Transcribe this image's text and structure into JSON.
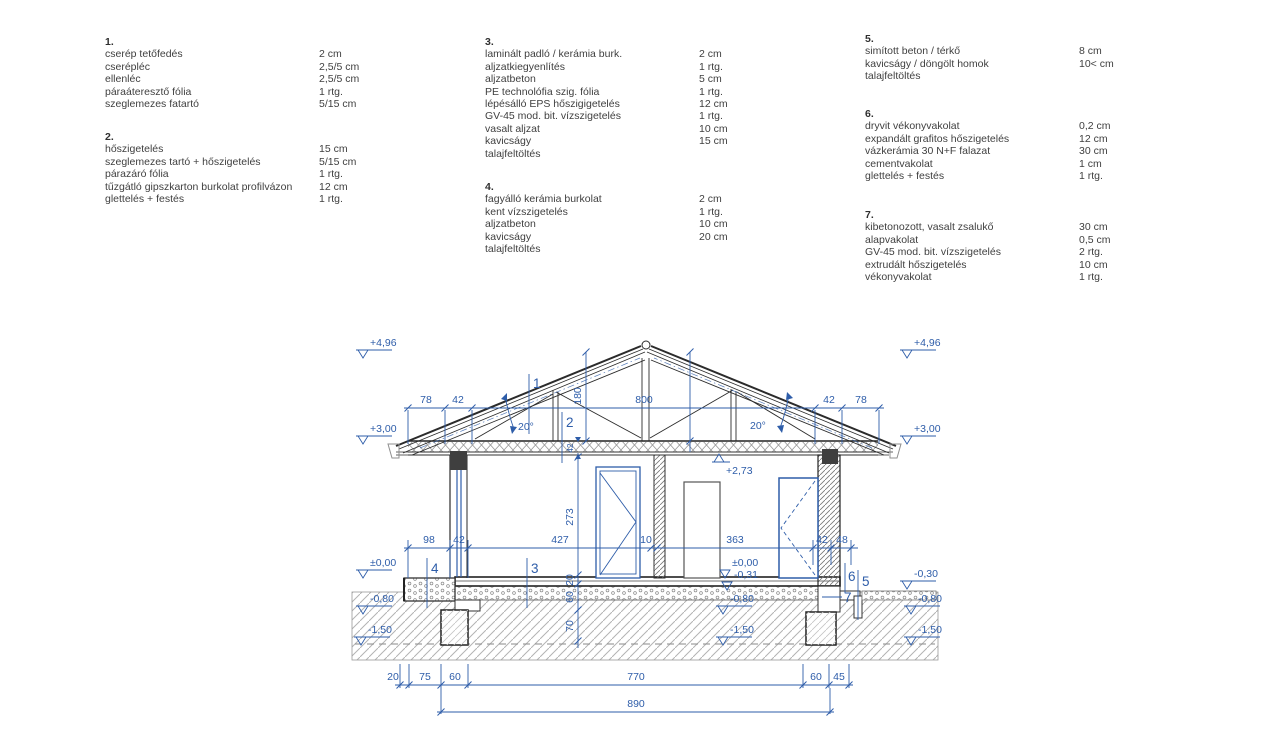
{
  "specs": {
    "s1": {
      "num": "1.",
      "rows": [
        [
          "cserép tetőfedés",
          "2 cm"
        ],
        [
          "cserépléc",
          "2,5/5 cm"
        ],
        [
          "ellenléc",
          "2,5/5 cm"
        ],
        [
          "páraáteresztő fólia",
          "1 rtg."
        ],
        [
          "szeglemezes fatartó",
          "5/15 cm"
        ]
      ]
    },
    "s2": {
      "num": "2.",
      "rows": [
        [
          "hőszigetelés",
          "15 cm"
        ],
        [
          "szeglemezes tartó + hőszigetelés",
          "5/15 cm"
        ],
        [
          "párazáró fólia",
          "1 rtg."
        ],
        [
          "tűzgátló gipszkarton burkolat profilvázon",
          "12 cm"
        ],
        [
          "glettelés + festés",
          "1 rtg."
        ]
      ]
    },
    "s3": {
      "num": "3.",
      "rows": [
        [
          "laminált padló / kerámia burk.",
          "2 cm"
        ],
        [
          "aljzatkiegyenlítés",
          "1 rtg."
        ],
        [
          "aljzatbeton",
          "5 cm"
        ],
        [
          "PE technolófia szig. fólia",
          "1 rtg."
        ],
        [
          "lépésálló EPS hőszigigetelés",
          "12 cm"
        ],
        [
          "GV-45 mod. bit. vízszigetelés",
          "1 rtg."
        ],
        [
          "vasalt aljzat",
          "10 cm"
        ],
        [
          "kavicságy",
          "15 cm"
        ],
        [
          "talajfeltöltés",
          ""
        ]
      ]
    },
    "s4": {
      "num": "4.",
      "rows": [
        [
          "fagyálló kerámia burkolat",
          "2 cm"
        ],
        [
          "kent vízszigetelés",
          "1 rtg."
        ],
        [
          "aljzatbeton",
          "10 cm"
        ],
        [
          "kavicságy",
          "20 cm"
        ],
        [
          "talajfeltöltés",
          ""
        ]
      ]
    },
    "s5": {
      "num": "5.",
      "rows": [
        [
          "simított beton / térkő",
          "8 cm"
        ],
        [
          "kavicságy / döngölt homok",
          "10< cm"
        ],
        [
          "talajfeltöltés",
          ""
        ]
      ]
    },
    "s6": {
      "num": "6.",
      "rows": [
        [
          "dryvit vékonyvakolat",
          "0,2 cm"
        ],
        [
          "expandált grafitos hőszigetelés",
          "12 cm"
        ],
        [
          "vázkerámia 30 N+F falazat",
          "30 cm"
        ],
        [
          "cementvakolat",
          "1 cm"
        ],
        [
          "glettelés + festés",
          "1 rtg."
        ]
      ]
    },
    "s7": {
      "num": "7.",
      "rows": [
        [
          "kibetonozott, vasalt zsalukő",
          "30 cm"
        ],
        [
          "alapvakolat",
          "0,5 cm"
        ],
        [
          "GV-45 mod. bit. vízszigetelés",
          "2 rtg."
        ],
        [
          "extrudált hőszigetelés",
          "10 cm"
        ],
        [
          "vékonyvakolat",
          "1 rtg."
        ]
      ]
    }
  },
  "drawing": {
    "colors": {
      "annotation_blue": "#2e5da9",
      "line_black": "#2b2b2b"
    },
    "levels": {
      "left_496": "+4,96",
      "left_300": "+3,00",
      "left_000": "±0,00",
      "left_080": "-0,80",
      "left_150": "-1,50",
      "right_496": "+4,96",
      "right_300": "+3,00",
      "right_030": "-0,30",
      "right_080": "-0,80",
      "right_150": "-1,50",
      "ceiling_273": "+2,73",
      "int_000": "±0,00",
      "int_031": "-0,31",
      "int_080": "-0,80",
      "int_150": "-1,50"
    },
    "dims": {
      "eave_l1": "78",
      "eave_l2": "42",
      "span": "800",
      "eave_r1": "42",
      "eave_r2": "78",
      "ridge": "180",
      "ceil": "42",
      "m1": "98",
      "m2": "42",
      "m3": "427",
      "m4": "10",
      "m5": "363",
      "m6": "42",
      "m7": "48",
      "v1": "273",
      "v2": "20",
      "v3": "60",
      "v4": "70",
      "b1": "20",
      "b2": "75",
      "b3": "60",
      "b4": "770",
      "b5": "60",
      "b6": "45",
      "total": "890"
    },
    "angle_left": "20°",
    "angle_right": "20°",
    "refs": {
      "r1": "1",
      "r2": "2",
      "r3": "3",
      "r4": "4",
      "r5": "5",
      "r6": "6",
      "r7": "7"
    }
  }
}
